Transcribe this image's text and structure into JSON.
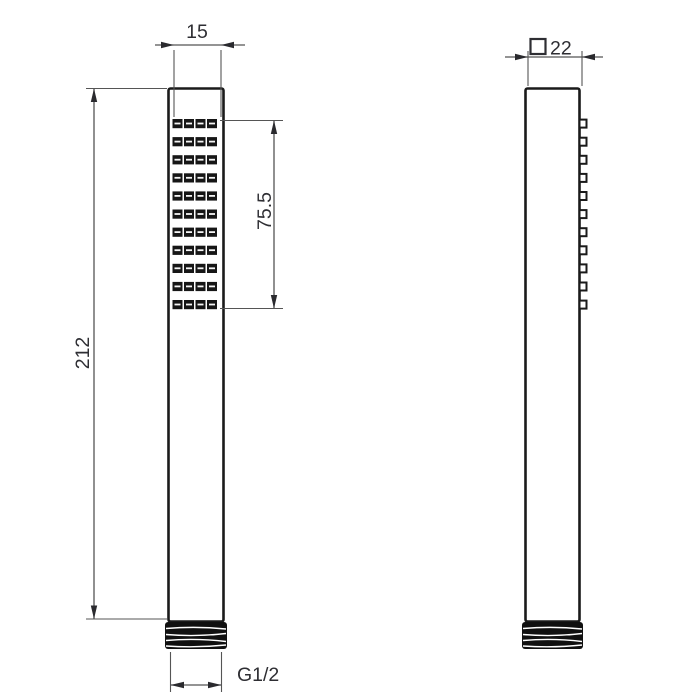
{
  "title": "Handheld shower wand technical drawing, front and side views",
  "colors": {
    "background": "#ffffff",
    "outline": "#1a1a1a",
    "dimension_line": "#555555",
    "text": "#2e2e33",
    "nozzle": "#161616",
    "thread": "#101010"
  },
  "front_view": {
    "dimensions": {
      "width_mm": "15",
      "nozzle_area_mm": "75.5",
      "total_length_mm": "212",
      "thread_label": "G1/2"
    },
    "nozzle_grid": {
      "rows": 11,
      "columns": 4
    }
  },
  "side_view": {
    "dimensions": {
      "depth_mm": "22",
      "depth_symbol": "square"
    },
    "nozzle_bumps": 11
  }
}
